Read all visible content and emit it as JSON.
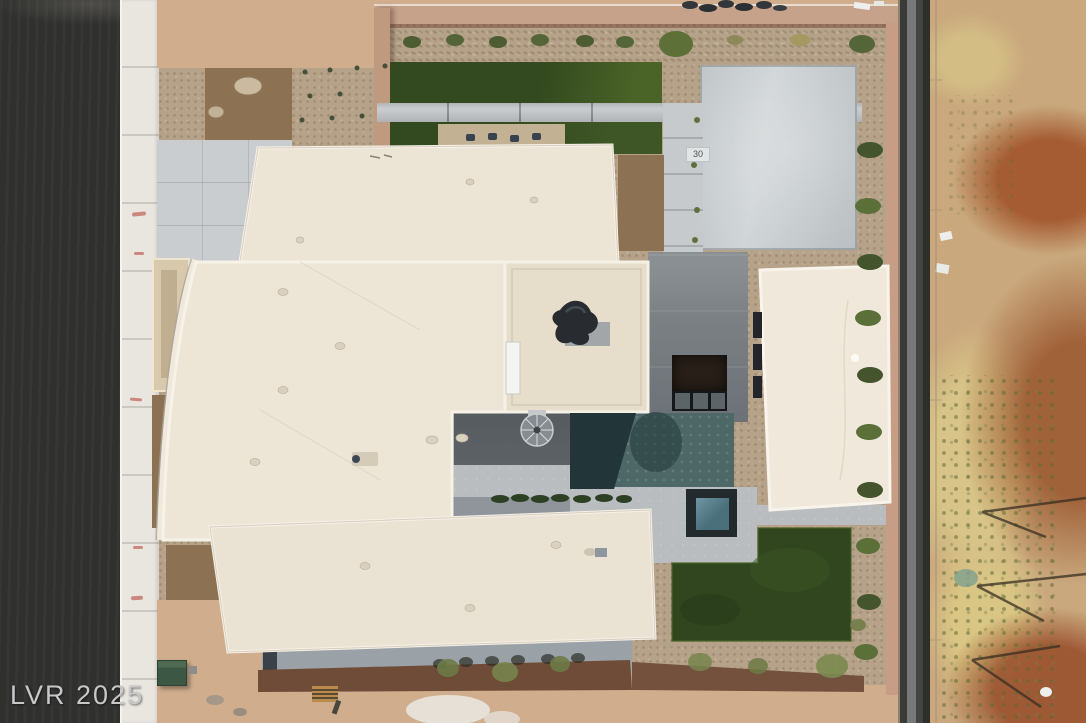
{
  "watermark": {
    "text": "LVR 2025"
  },
  "markers": {
    "driveway_paver_label": "30"
  },
  "colors": {
    "asphalt": "#30302e",
    "sidewalk": "#e9e6e0",
    "dirt": "#d0ae8d",
    "gravel": "#b5a288",
    "planting_bed": "#8c7253",
    "turf_dark": "#33491f",
    "turf_light": "#4a6428",
    "concrete_paver": "#c9cdd0",
    "driveway": "#ced3d5",
    "roof_cream": "#ece4d5",
    "roof_bright": "#f7f2e8",
    "patio_gray": "#7b8085",
    "court_gray": "#5d6266",
    "pool_dark": "#23383c",
    "pool_light": "#4e6867",
    "spa_dark": "#232a2e",
    "spa_water": "#4a717b",
    "deck_light": "#b9bdc0",
    "perimeter_wall_pink": "#c79e85",
    "block_wall_dark": "#454543",
    "desert_base": "#c9a87d",
    "desert_rust": "#a55c33",
    "desert_straw": "#d8c488",
    "olive_green": "#6d7a46",
    "shrub_green": "#4d5c33",
    "walkway_brown": "#6f4c38",
    "utility_box_green": "#3c5845",
    "watermark_gray": "#c8c8ca"
  }
}
